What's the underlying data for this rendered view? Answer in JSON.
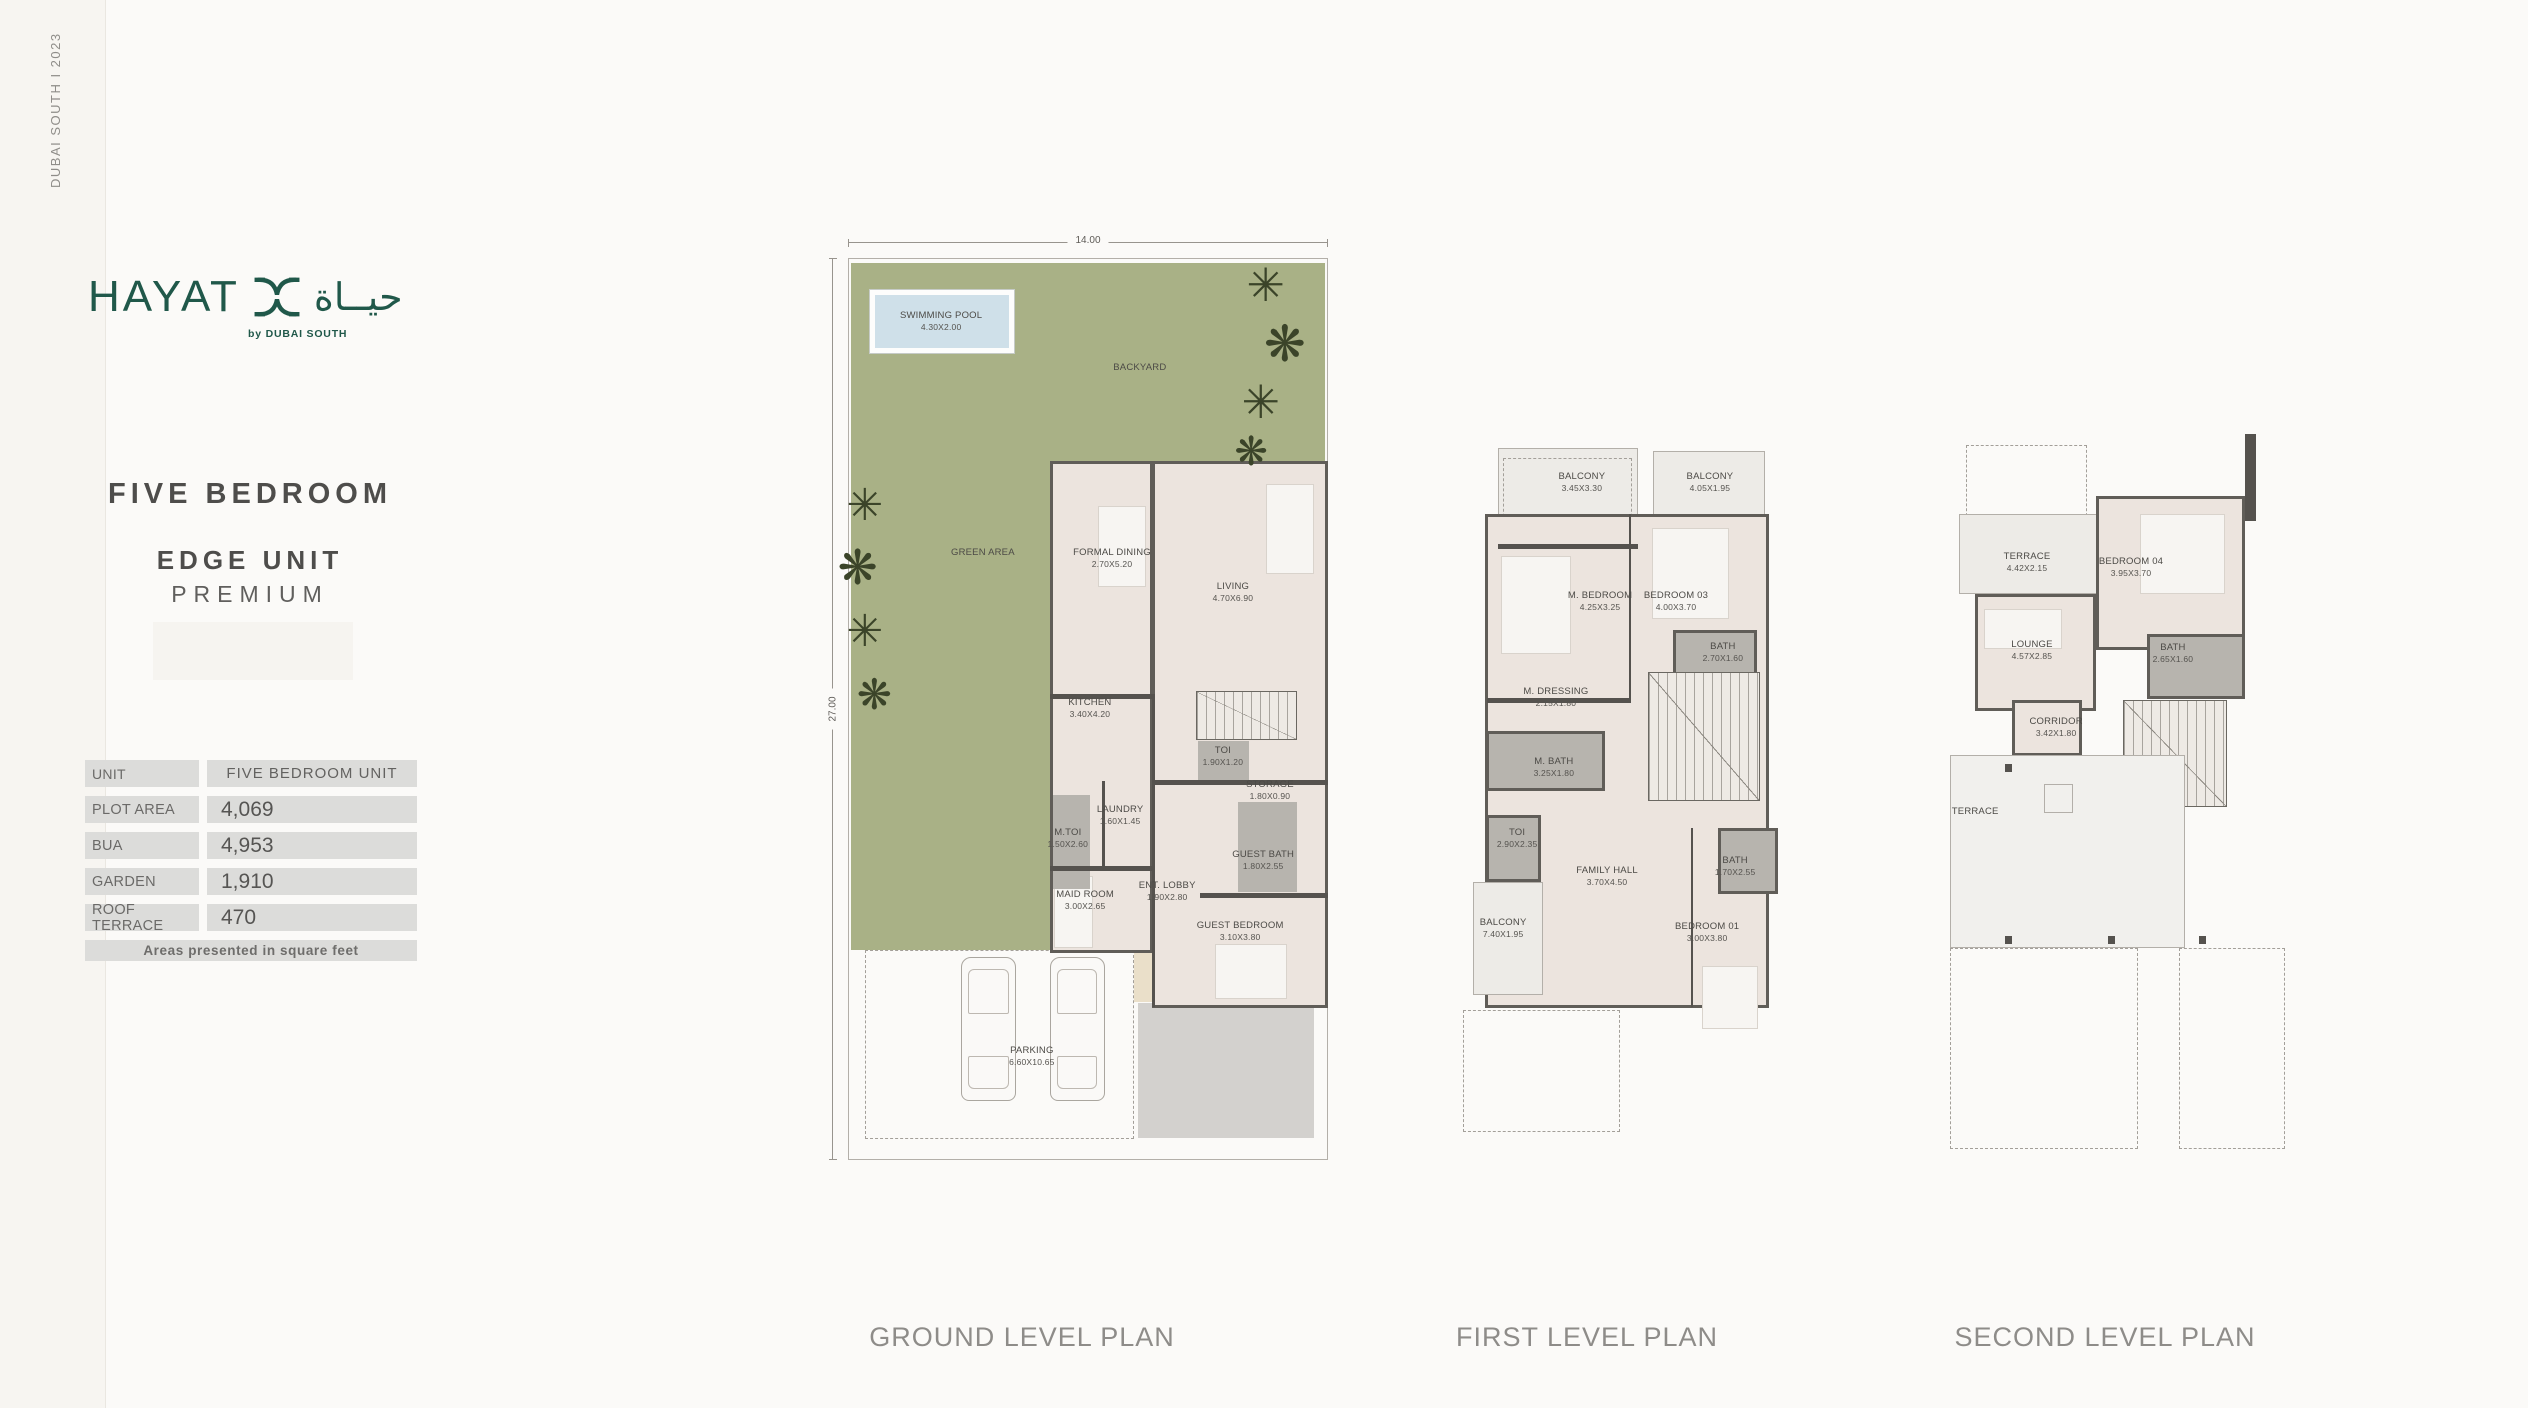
{
  "page": {
    "edge_text": "DUBAI SOUTH  I  2023"
  },
  "brand": {
    "name": "HAYAT",
    "arabic": "حيــاة",
    "byline": "by DUBAI SOUTH",
    "color": "#20584a"
  },
  "unit": {
    "title": "FIVE BEDROOM",
    "subtitle": "EDGE UNIT",
    "subtitle2": "PREMIUM"
  },
  "specs": {
    "rows": [
      {
        "label": "UNIT",
        "value": "FIVE BEDROOM UNIT"
      },
      {
        "label": "PLOT AREA",
        "value": "4,069"
      },
      {
        "label": "BUA",
        "value": "4,953"
      },
      {
        "label": "GARDEN",
        "value": "1,910"
      },
      {
        "label": "ROOF TERRACE",
        "value": "470"
      }
    ],
    "footnote": "Areas presented in square feet"
  },
  "colors": {
    "brand_green": "#20584a",
    "garden_green": "#a9b186",
    "pool_blue": "#cfe0e9",
    "wall_gray": "#605d58"
  },
  "plans": [
    {
      "caption": "GROUND LEVEL PLAN",
      "caption_x": 1022,
      "frame": [
        848,
        258,
        480,
        902
      ],
      "dims": {
        "w": "14.00",
        "h": "27.00"
      },
      "regions": [
        {
          "box": [
            0,
            0,
            100,
            100
          ],
          "k": "none",
          "thin": true
        },
        {
          "box": [
            0.6,
            0.5,
            98.8,
            22
          ],
          "k": "green"
        },
        {
          "box": [
            0.6,
            0.5,
            41.4,
            76.2
          ],
          "k": "green"
        },
        {
          "box": [
            3.5,
            76.7,
            56,
            21
          ],
          "k": "white",
          "dash": true
        },
        {
          "box": [
            60.5,
            82.6,
            36.5,
            15
          ],
          "k": "drive"
        },
        {
          "box": [
            59.5,
            76.7,
            9,
            5.8
          ],
          "k": "tan"
        },
        {
          "box": [
            42,
            22.5,
            21.6,
            54.5
          ],
          "k": "floor",
          "wall": true
        },
        {
          "box": [
            63.4,
            22.5,
            36.6,
            60.6
          ],
          "k": "floor",
          "wall": true
        },
        {
          "box": [
            4.5,
            3.5,
            30,
            7
          ],
          "k": "pool"
        },
        {
          "box": [
            52,
            27.5,
            10,
            9
          ],
          "k": "furn"
        },
        {
          "box": [
            87,
            25,
            10,
            10
          ],
          "k": "furn"
        },
        {
          "box": [
            43,
            68.5,
            8,
            8
          ],
          "k": "furn"
        },
        {
          "box": [
            76.5,
            76,
            15,
            6.2
          ],
          "k": "furn"
        },
        {
          "box": [
            42.8,
            59.5,
            7.6,
            10.5
          ],
          "k": "gray"
        },
        {
          "box": [
            73,
            53.6,
            10.5,
            4.8
          ],
          "k": "gray"
        },
        {
          "box": [
            81.3,
            60.3,
            12.3,
            10
          ],
          "k": "gray"
        },
        {
          "box": [
            72.5,
            48,
            21,
            5.4
          ],
          "k": "none",
          "stairs": true
        },
        {
          "box": [
            42,
            48.3,
            21.8,
            0.55
          ],
          "k": "dark"
        },
        {
          "box": [
            63.4,
            48.3,
            0.6,
            34.7
          ],
          "k": "dark"
        },
        {
          "box": [
            63.4,
            57.9,
            36.6,
            0.55
          ],
          "k": "dark"
        },
        {
          "box": [
            42,
            67.4,
            21.4,
            0.55
          ],
          "k": "dark"
        },
        {
          "box": [
            53,
            58,
            0.55,
            9.5
          ],
          "k": "dark"
        },
        {
          "box": [
            73.4,
            70.4,
            26.6,
            0.55
          ],
          "k": "dark"
        }
      ],
      "labels": [
        {
          "t": "SWIMMING POOL",
          "d": "4.30X2.00",
          "x": 19.4,
          "y": 7
        },
        {
          "t": "BACKYARD",
          "d": "",
          "x": 60.8,
          "y": 12.2
        },
        {
          "t": "GREEN AREA",
          "d": "",
          "x": 28.1,
          "y": 32.7
        },
        {
          "t": "FORMAL DINING",
          "d": "2.70X5.20",
          "x": 55,
          "y": 33.3
        },
        {
          "t": "LIVING",
          "d": "4.70X6.90",
          "x": 80.2,
          "y": 37
        },
        {
          "t": "KITCHEN",
          "d": "3.40X4.20",
          "x": 50.4,
          "y": 49.9
        },
        {
          "t": "TOI",
          "d": "1.90X1.20",
          "x": 78.1,
          "y": 55.2
        },
        {
          "t": "STORAGE",
          "d": "1.80X0.90",
          "x": 87.9,
          "y": 59
        },
        {
          "t": "LAUNDRY",
          "d": "1.60X1.45",
          "x": 56.7,
          "y": 61.8
        },
        {
          "t": "M.TOI",
          "d": "1.50X2.60",
          "x": 45.8,
          "y": 64.3
        },
        {
          "t": "GUEST BATH",
          "d": "1.80X2.55",
          "x": 86.5,
          "y": 66.7
        },
        {
          "t": "MAID ROOM",
          "d": "3.00X2.65",
          "x": 49.4,
          "y": 71.2
        },
        {
          "t": "ENT. LOBBY",
          "d": "1.90X2.80",
          "x": 66.5,
          "y": 70.2
        },
        {
          "t": "GUEST BEDROOM",
          "d": "3.10X3.80",
          "x": 81.7,
          "y": 74.6
        },
        {
          "t": "PARKING",
          "d": "6.60X10.65",
          "x": 38.3,
          "y": 88.5
        }
      ],
      "trees": [
        {
          "x": 87,
          "y": 3,
          "s": 46
        },
        {
          "x": 91,
          "y": 9.5,
          "s": 50
        },
        {
          "x": 86,
          "y": 16,
          "s": 46
        },
        {
          "x": 84,
          "y": 21.5,
          "s": 40
        },
        {
          "x": 3.5,
          "y": 27.5,
          "s": 44
        },
        {
          "x": 2,
          "y": 34.5,
          "s": 48
        },
        {
          "x": 3.5,
          "y": 41.5,
          "s": 44
        },
        {
          "x": 5.5,
          "y": 48.5,
          "s": 42
        }
      ],
      "cars": [
        {
          "x": 23.5,
          "y": 77.5,
          "w": 11.5,
          "h": 16
        },
        {
          "x": 42,
          "y": 77.5,
          "w": 11.5,
          "h": 16
        }
      ]
    },
    {
      "caption": "FIRST LEVEL PLAN",
      "caption_x": 1587,
      "frame": [
        1452,
        437,
        350,
        700
      ],
      "regions": [
        {
          "box": [
            13,
            1.5,
            40,
            13.5
          ],
          "k": "light",
          "thin": true
        },
        {
          "box": [
            14.5,
            3,
            37,
            10.5
          ],
          "k": "none",
          "dash": true
        },
        {
          "box": [
            57.5,
            2,
            32,
            9.5
          ],
          "k": "light",
          "thin": true
        },
        {
          "box": [
            9.5,
            11,
            81,
            70.5
          ],
          "k": "floor",
          "wall": true
        },
        {
          "box": [
            14,
            17,
            20,
            14
          ],
          "k": "furn"
        },
        {
          "box": [
            57,
            13,
            22,
            13
          ],
          "k": "furn"
        },
        {
          "box": [
            71.5,
            75.5,
            16,
            9
          ],
          "k": "furn"
        },
        {
          "box": [
            63,
            27.5,
            24,
            7.5
          ],
          "k": "gray",
          "wall": true
        },
        {
          "box": [
            9.8,
            42,
            34,
            8.6
          ],
          "k": "gray",
          "wall": true
        },
        {
          "box": [
            9.8,
            54,
            15.5,
            9.5
          ],
          "k": "gray",
          "wall": true
        },
        {
          "box": [
            76,
            55.8,
            17,
            9.5
          ],
          "k": "gray",
          "wall": true
        },
        {
          "box": [
            6,
            63.5,
            20,
            16.2
          ],
          "k": "light",
          "thin": true
        },
        {
          "box": [
            56,
            33.5,
            32,
            18.5
          ],
          "k": "none",
          "stairs": true
        },
        {
          "box": [
            3,
            81.8,
            45,
            17.5
          ],
          "k": "none",
          "dash": true
        },
        {
          "box": [
            13,
            15.3,
            40,
            0.7
          ],
          "k": "dark"
        },
        {
          "box": [
            50.5,
            11,
            0.7,
            26.5
          ],
          "k": "dark"
        },
        {
          "box": [
            10,
            37.3,
            41,
            0.7
          ],
          "k": "dark"
        },
        {
          "box": [
            68.3,
            55.8,
            0.7,
            25.7
          ],
          "k": "dark"
        }
      ],
      "labels": [
        {
          "t": "BALCONY",
          "d": "3.45X3.30",
          "x": 37.1,
          "y": 6.4
        },
        {
          "t": "BALCONY",
          "d": "4.05X1.95",
          "x": 73.7,
          "y": 6.4
        },
        {
          "t": "M. BEDROOM",
          "d": "4.25X3.25",
          "x": 42.3,
          "y": 23.4
        },
        {
          "t": "BEDROOM 03",
          "d": "4.00X3.70",
          "x": 64,
          "y": 23.4
        },
        {
          "t": "BATH",
          "d": "2.70X1.60",
          "x": 77.4,
          "y": 30.7
        },
        {
          "t": "M. DRESSING",
          "d": "2.15X1.80",
          "x": 29.7,
          "y": 37.1
        },
        {
          "t": "M. BATH",
          "d": "3.25X1.80",
          "x": 29.1,
          "y": 47.1
        },
        {
          "t": "TOI",
          "d": "2.90X2.35",
          "x": 18.6,
          "y": 57.3
        },
        {
          "t": "FAMILY HALL",
          "d": "3.70X4.50",
          "x": 44.3,
          "y": 62.7
        },
        {
          "t": "BATH",
          "d": "1.70X2.55",
          "x": 80.9,
          "y": 61.3
        },
        {
          "t": "BALCONY",
          "d": "7.40X1.95",
          "x": 14.6,
          "y": 70.1
        },
        {
          "t": "BEDROOM 01",
          "d": "3.00X3.80",
          "x": 72.9,
          "y": 70.7
        }
      ]
    },
    {
      "caption": "SECOND LEVEL PLAN",
      "caption_x": 2105,
      "frame": [
        1945,
        430,
        355,
        730
      ],
      "regions": [
        {
          "box": [
            6,
            2,
            34,
            10.5
          ],
          "k": "none",
          "dash": true
        },
        {
          "box": [
            84.5,
            0.5,
            3.2,
            12
          ],
          "k": "dark"
        },
        {
          "box": [
            4,
            11.5,
            39,
            11
          ],
          "k": "light",
          "thin": true
        },
        {
          "box": [
            42.5,
            9,
            42,
            21.2
          ],
          "k": "floor",
          "wall": true
        },
        {
          "box": [
            55,
            11.5,
            24,
            11
          ],
          "k": "furn"
        },
        {
          "box": [
            8.5,
            22.5,
            34,
            16
          ],
          "k": "floor",
          "wall": true
        },
        {
          "box": [
            11,
            24.5,
            22,
            5.5
          ],
          "k": "furn"
        },
        {
          "box": [
            57,
            28,
            27.5,
            8.8
          ],
          "k": "gray",
          "wall": true
        },
        {
          "box": [
            19,
            37,
            19.5,
            7.6
          ],
          "k": "floor",
          "wall": true
        },
        {
          "box": [
            50,
            37,
            29.5,
            14.6
          ],
          "k": "none",
          "stairs": true
        },
        {
          "box": [
            1.5,
            44.5,
            66,
            26.5
          ],
          "k": "lighter",
          "thin": true
        },
        {
          "box": [
            28,
            48.5,
            8,
            4
          ],
          "k": "none",
          "thin": true
        },
        {
          "box": [
            17,
            45.8,
            2,
            1.1
          ],
          "k": "dark"
        },
        {
          "box": [
            17,
            69.3,
            2,
            1.1
          ],
          "k": "dark"
        },
        {
          "box": [
            46,
            69.3,
            2,
            1.1
          ],
          "k": "dark"
        },
        {
          "box": [
            71.5,
            69.3,
            2,
            1.1
          ],
          "k": "dark"
        },
        {
          "box": [
            1.5,
            71,
            53,
            27.5
          ],
          "k": "none",
          "dash": true
        },
        {
          "box": [
            65.9,
            70.9,
            30,
            27.6
          ],
          "k": "none",
          "dash": true
        }
      ],
      "labels": [
        {
          "t": "TERRACE",
          "d": "4.42X2.15",
          "x": 23.1,
          "y": 18.1
        },
        {
          "t": "BEDROOM 04",
          "d": "3.95X3.70",
          "x": 52.4,
          "y": 18.8
        },
        {
          "t": "LOUNGE",
          "d": "4.57X2.85",
          "x": 24.5,
          "y": 30.1
        },
        {
          "t": "BATH",
          "d": "2.65X1.60",
          "x": 64.2,
          "y": 30.5
        },
        {
          "t": "CORRIDOR",
          "d": "3.42X1.80",
          "x": 31.3,
          "y": 40.7
        },
        {
          "t": "TERRACE",
          "d": "",
          "x": 8.5,
          "y": 52.3
        }
      ]
    }
  ]
}
